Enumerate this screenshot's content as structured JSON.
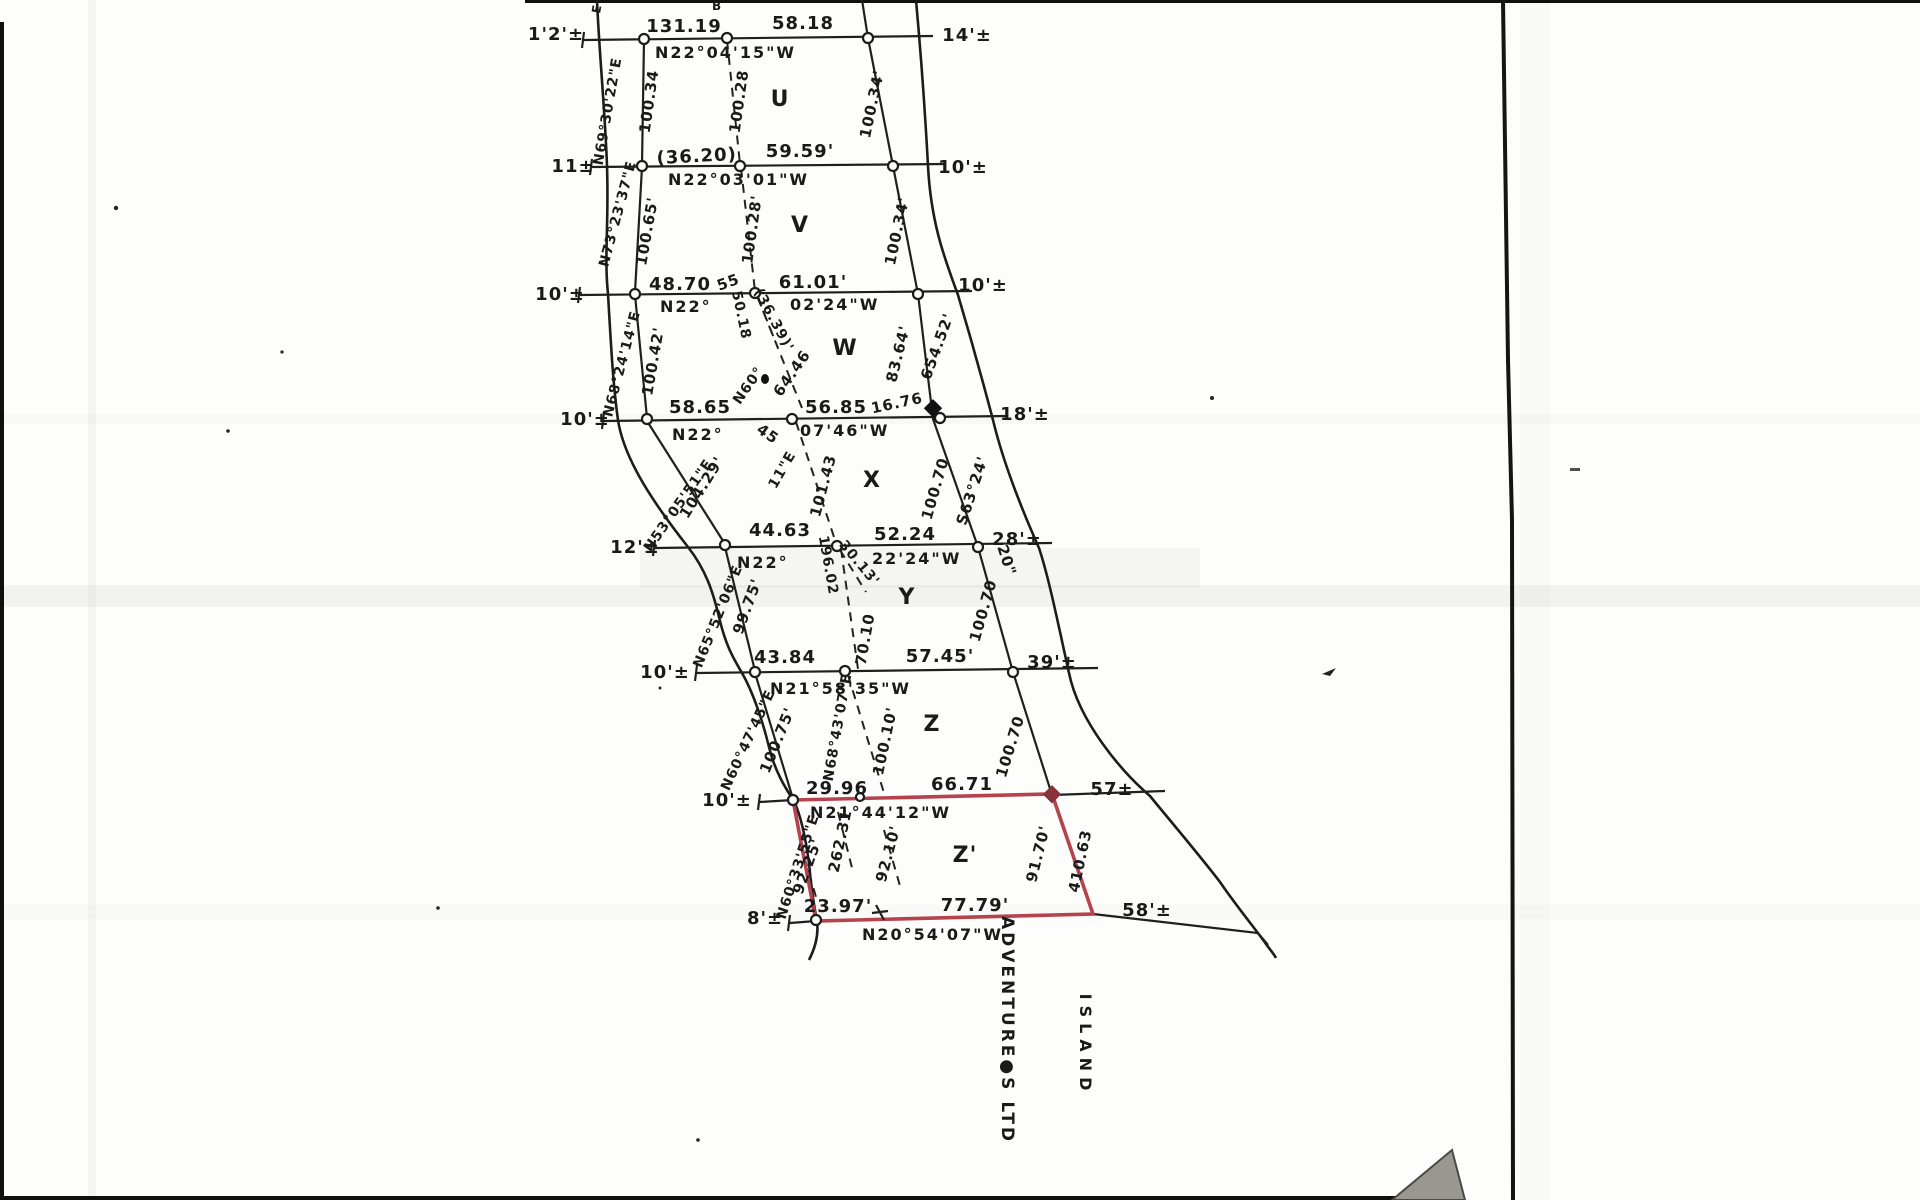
{
  "plat": {
    "rows": [
      {
        "left": "1'2'±",
        "d1": "131.19",
        "d2": "58.18",
        "bearing": "N22°04'15\"W",
        "right": "14'±"
      },
      {
        "left": "11±",
        "d1": "(36.20)",
        "d2": "59.59'",
        "bearing": "N22°03'01\"W",
        "right": "10'±"
      },
      {
        "left": "10'±",
        "d1": "48.70",
        "d1b": "55",
        "d2": "61.01'",
        "bearing_a": "N22°",
        "bearing_b": "50.18",
        "bearing_c": "02'24\"W",
        "tie": "(36.39)'",
        "right": "10'±"
      },
      {
        "left": "10'±",
        "d1": "58.65",
        "d2": "56.85",
        "d3": "16.76",
        "bearing_a": "N22°",
        "bearing_b": "45",
        "bearing_c": "07'46\"W",
        "right": "18'±"
      },
      {
        "left": "12'±",
        "d1": "44.63",
        "d2": "52.24",
        "bearing_a": "N22°",
        "bearing_b": "196.02",
        "bearing_c": "30.13'",
        "bearing_d": "22'24\"W",
        "sec": "20\"",
        "right": "28'±"
      },
      {
        "left": "10'±",
        "d1": "43.84",
        "d2": "57.45'",
        "bearing": "N21°58'35\"W",
        "right": "39'±"
      },
      {
        "left": "10'±",
        "d1": "29.96",
        "d2": "66.71",
        "bearing": "N21°44'12\"W",
        "right": "57±"
      },
      {
        "left": "8'±",
        "d1": "23.97'",
        "d2": "77.79'",
        "bearing": "N20°54'07\"W",
        "right": "58'±"
      }
    ],
    "lots": [
      {
        "name": "U",
        "left_bearing": "N69°30'22\"E",
        "left_len": "100.34",
        "interior": "100.28",
        "right_len": "100.34'"
      },
      {
        "name": "V",
        "left_bearing": "N73°23'37\"E",
        "left_len": "100.65'",
        "interior": "100.28'",
        "right_len": "100.34'"
      },
      {
        "name": "W",
        "left_bearing": "N68°24'14\"E",
        "left_len": "100.42'",
        "diag_bearing": "N60°",
        "diag_len": "64.46",
        "right_len": "83.64'"
      },
      {
        "name": "X",
        "left_bearing": "N53°05'51\"E",
        "left_len": "104.29'",
        "interior": "101.43",
        "diag_note": "11\"E",
        "right_len": "100.70"
      },
      {
        "name": "Y",
        "left_bearing": "N65°52'06\"E",
        "left_len": "99.75'",
        "interior": "70.10",
        "right_len": "100.70"
      },
      {
        "name": "Z",
        "left_bearing": "N60°47'45\"E",
        "left_len": "100.75'",
        "diag_bearing": "N68°43'07\"E",
        "interior": "100.10'",
        "right_len": "100.70"
      },
      {
        "name": "Z'",
        "left_bearing": "N60°33'55\"E",
        "dim1": "262.31",
        "dim2": "92.25'",
        "dim3": "92.10'",
        "right_len": "91.70'"
      }
    ],
    "shore": {
      "bearing1": "S63°24'",
      "seconds": "20\"",
      "len1": "654.52'",
      "traverse_len": "410.63"
    },
    "footer": {
      "company": "ADVENTURE●S LTD",
      "island": "ISLAND"
    },
    "fragments": {
      "f1": "E",
      "f2": "B"
    }
  }
}
